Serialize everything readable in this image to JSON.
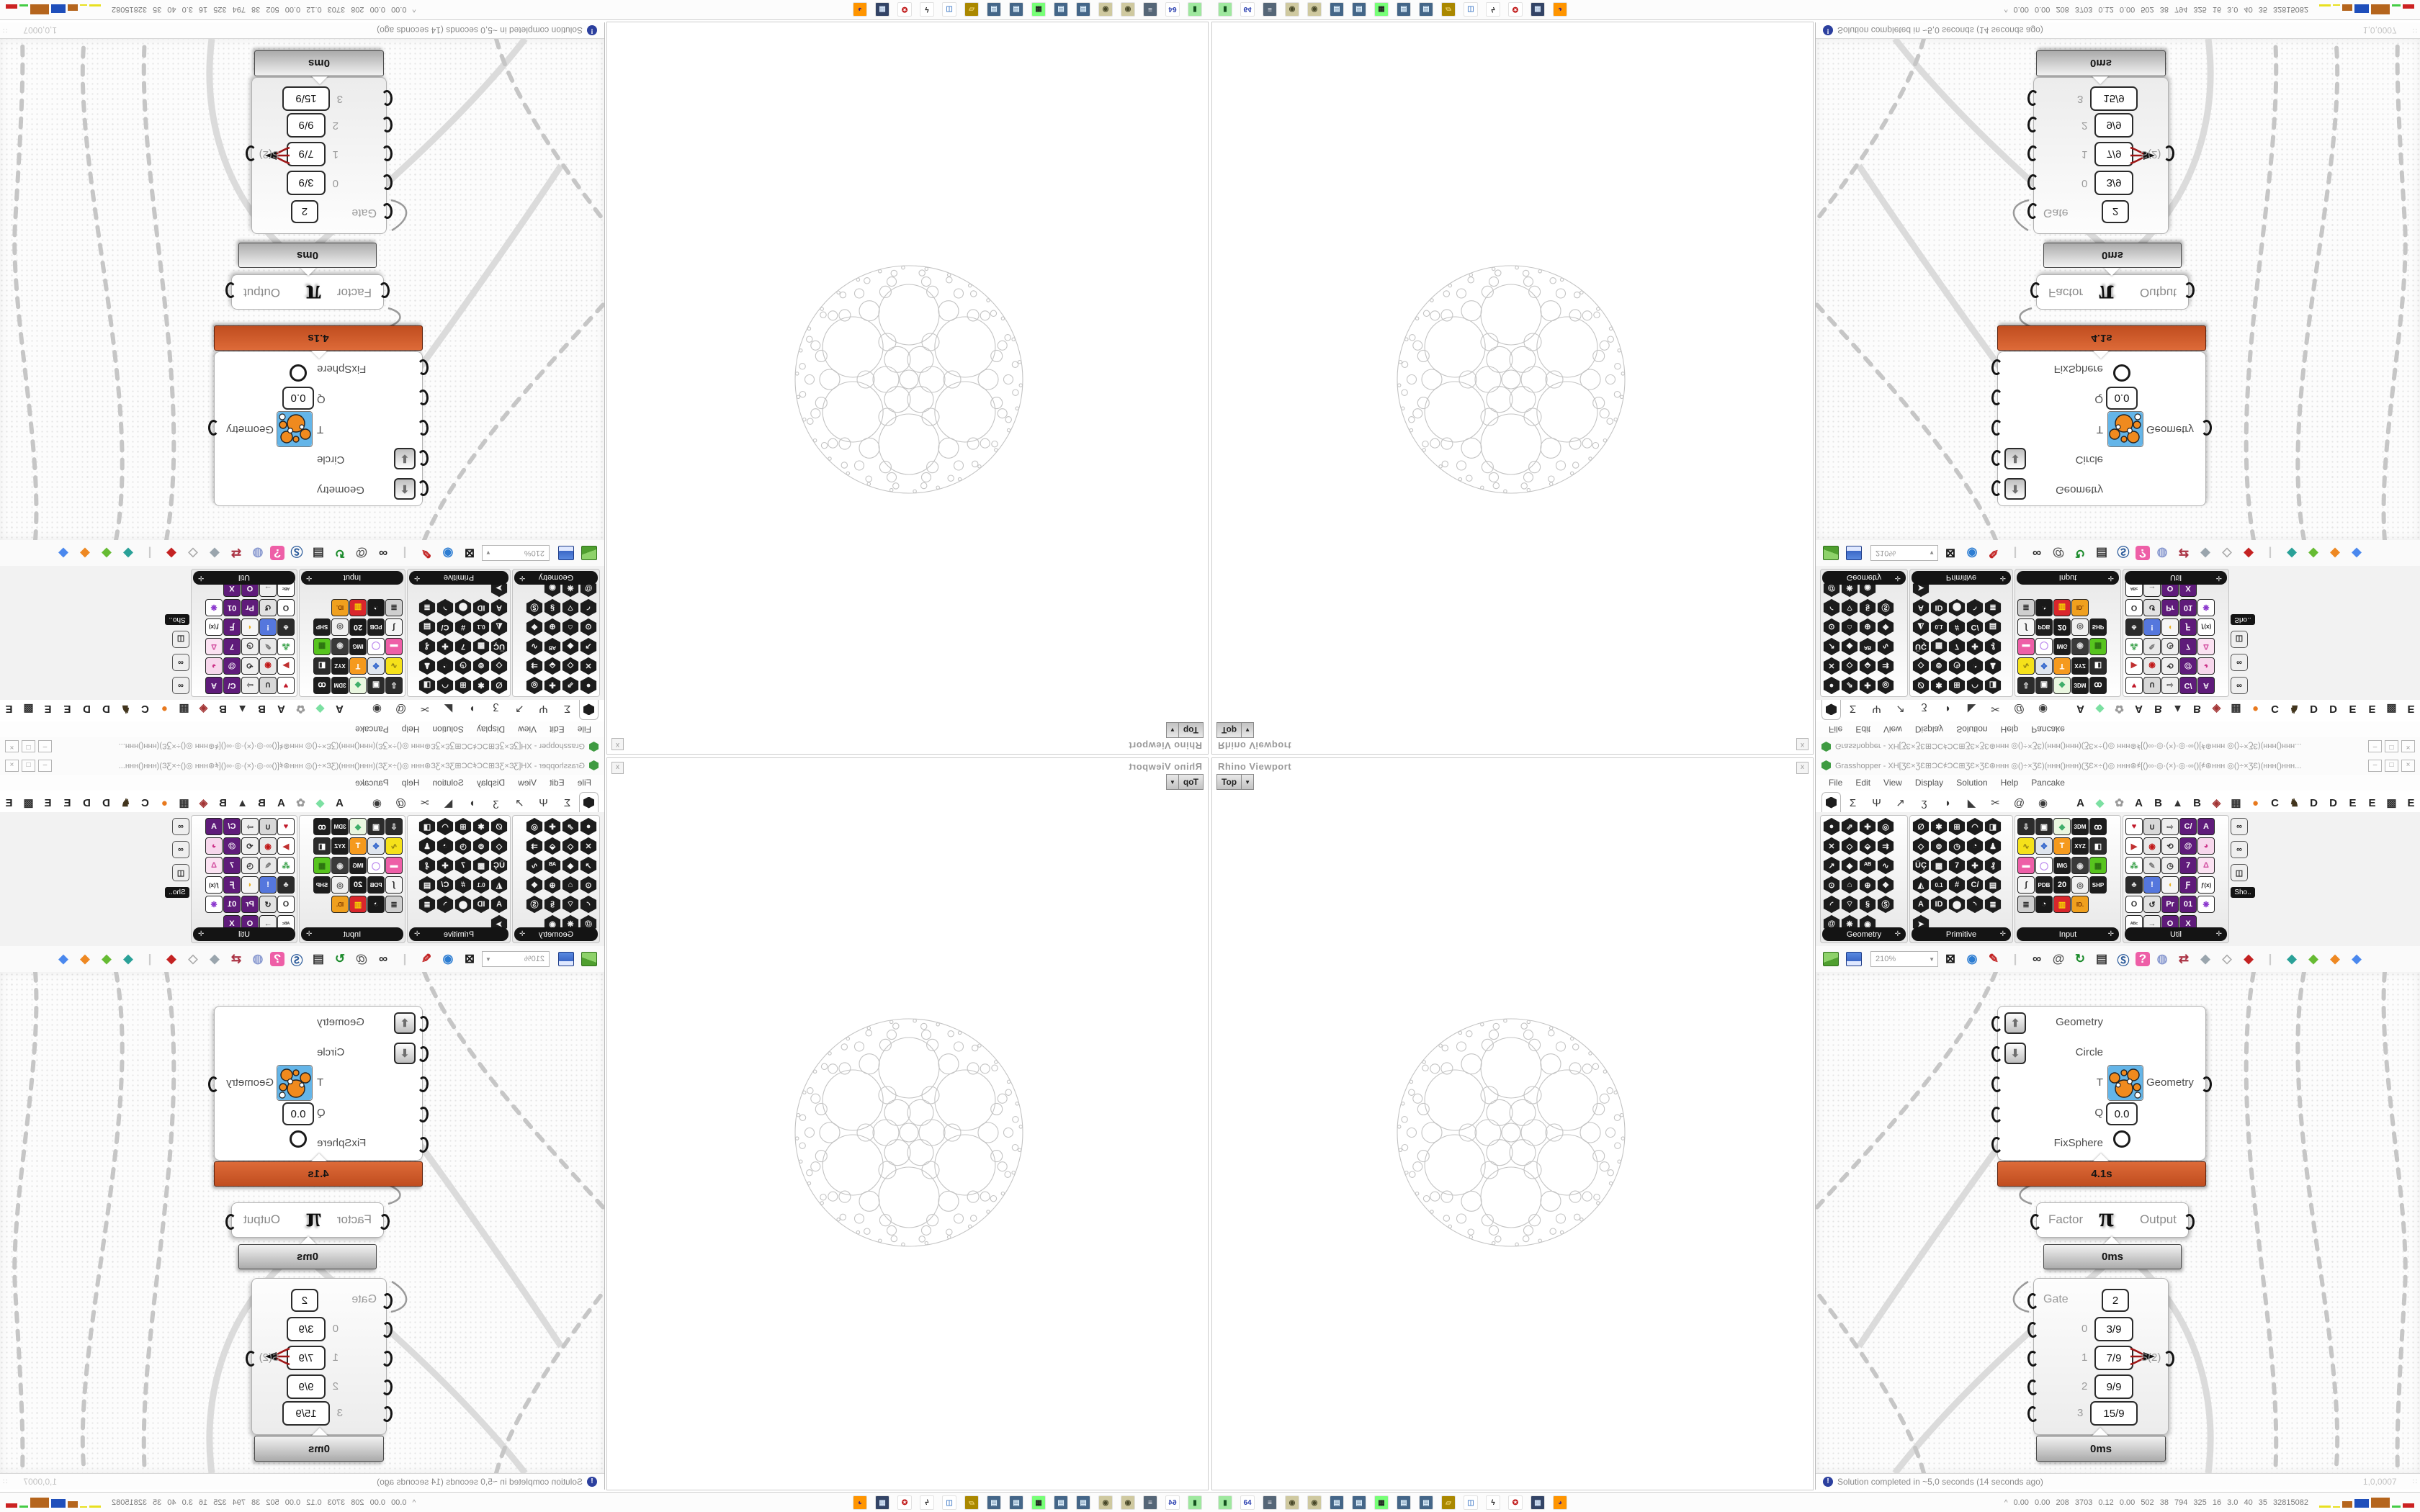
{
  "rhino_viewport": {
    "title": "Rhino Viewport",
    "close_label": "x",
    "viewport_tab": "Top",
    "drop_glyph": "▼"
  },
  "grasshopper": {
    "title": "Grasshopper - XH[ƷƐ×ƷƐ⊞ƆC҂ƆC⊞ƷƐ×ƷƐ⊛ʜʜʜ ◎()÷×ƷƐ)(ʜʜʜ()ʜʜʜ)(ƷƐ×÷()◎ ʜʜʜ⊛҂[()∞·◎·(×)·◎·∞()[҂⊛ʜʜʜ ◎()÷×ƷƐ)(ʜʜʜ()ʜʜʜ...",
    "window_buttons": [
      "–",
      "□",
      "×"
    ],
    "menu": [
      "File",
      "Edit",
      "View",
      "Display",
      "Solution",
      "Help",
      "Pancake"
    ],
    "tab_glyphs": [
      "Σ",
      "Ψ",
      "↗",
      "ʒ",
      "◗",
      "◣",
      "✂",
      "@",
      "◉"
    ],
    "plugin_tabs": [
      [
        "A",
        "#222"
      ],
      [
        "◆",
        "#7ce0a2"
      ],
      [
        "✿",
        "#999"
      ],
      [
        "A",
        "#222"
      ],
      [
        "B",
        "#222"
      ],
      [
        "▲",
        "#333"
      ],
      [
        "B",
        "#222"
      ],
      [
        "◈",
        "#a23333"
      ],
      [
        "▦",
        "#333"
      ],
      [
        "●",
        "#e8791e"
      ],
      [
        "C",
        "#222"
      ],
      [
        "♞",
        "#42351d"
      ],
      [
        "D",
        "#222"
      ],
      [
        "D",
        "#222"
      ],
      [
        "E",
        "#222"
      ],
      [
        "E",
        "#222"
      ],
      [
        "▩",
        "#333"
      ],
      [
        "E",
        "#222"
      ]
    ],
    "palette": {
      "groups": [
        {
          "name": "Geometry",
          "cols": 4,
          "style": "dark",
          "glyphs": [
            "●",
            "⇗",
            "✚",
            "◎",
            "✕",
            "◇",
            "⬙",
            "⇉",
            "↗",
            "◆",
            "ᴬᴮ",
            "∿",
            "⊙",
            "⌂",
            "⊕",
            "❖",
            "◜",
            "⌔",
            "§",
            "Ⓢ",
            "@",
            "❋",
            "◉"
          ]
        },
        {
          "name": "Primitive",
          "cols": 5,
          "style": "dark",
          "glyphs": [
            "∅",
            "✱",
            "⊞",
            "◠",
            "◨",
            "◇",
            "⊚",
            "◷",
            "◔",
            "♟",
            "ÜÇ",
            "▩",
            "7",
            "✚",
            "₰",
            "◭",
            "0.1",
            "#",
            "C/",
            "▤",
            "A",
            "ID",
            "⬤",
            "◝",
            "≣",
            "➤"
          ]
        },
        {
          "name": "Input",
          "cols": 5,
          "style": "color",
          "icons": [
            [
              "⇩",
              "#2b2b2b",
              "#fff"
            ],
            [
              "▣",
              "#2b2b2b",
              "#fff"
            ],
            [
              "◆",
              "#e9f6df",
              "#3fae6a"
            ],
            [
              "3DM",
              "#1d1d1d",
              "#fff"
            ],
            [
              "ꝏ",
              "#1d1d1d",
              "#fff"
            ],
            [
              "∿",
              "#f5e11a",
              "#8a7a10"
            ],
            [
              "✥",
              "#dfe5ee",
              "#3366cc"
            ],
            [
              "T",
              "#f59a1e",
              "#fff"
            ],
            [
              "XYZ",
              "#1d1d1d",
              "#fff"
            ],
            [
              "◧",
              "#2b2b2b",
              "#fff"
            ],
            [
              "▬",
              "#ee5fa7",
              "#fff"
            ],
            [
              "◯",
              "#ffffff",
              "#bb88ee"
            ],
            [
              "IMG",
              "#1d1d1d",
              "#fff"
            ],
            [
              "◉",
              "#3a3a3a",
              "#ddd"
            ],
            [
              "▦",
              "#57c41e",
              "#2a6e10"
            ],
            [
              "∫",
              "#f4f4f4",
              "#222"
            ],
            [
              "PDB",
              "#1d1d1d",
              "#fff"
            ],
            [
              "20",
              "#191919",
              "#fff"
            ],
            [
              "◎",
              "#efefef",
              "#555"
            ],
            [
              "SHP",
              "#1d1d1d",
              "#fff"
            ],
            [
              "≣",
              "#cfcfcf",
              "#333"
            ],
            [
              "◔",
              "#191919",
              "#fff"
            ],
            [
              "▥",
              "#d9262c",
              "#f5d800"
            ],
            [
              "ID.",
              "#f0a01e",
              "#7a3500"
            ]
          ]
        },
        {
          "name": "Util",
          "cols": 5,
          "style": "color",
          "icons": [
            [
              "♥",
              "#ffffff",
              "#c01828"
            ],
            [
              "∪",
              "#d8d8d8",
              "#222"
            ],
            [
              "⇨",
              "#eeeeee",
              "#666"
            ],
            [
              "C/",
              "#5f1b7a",
              "#fff"
            ],
            [
              "A",
              "#5f1b7a",
              "#fff"
            ],
            [
              "▶",
              "#ffffff",
              "#c03030"
            ],
            [
              "◉",
              "#e8e8e8",
              "#c01818"
            ],
            [
              "⟲",
              "#efefef",
              "#333"
            ],
            [
              "@",
              "#5f1b7a",
              "#fff"
            ],
            [
              "◕",
              "#f7d7ec",
              "#cc3388"
            ],
            [
              "⁂",
              "#ffffff",
              "#38a048"
            ],
            [
              "✎",
              "#e8e8e8",
              "#777"
            ],
            [
              "◷",
              "#efefef",
              "#333"
            ],
            [
              "7",
              "#5f1b7a",
              "#fff"
            ],
            [
              "Δ",
              "#fbe2f2",
              "#d24fa0"
            ],
            [
              "♣",
              "#2b2b2b",
              "#ddd"
            ],
            [
              "!",
              "#5577dd",
              "#fff"
            ],
            [
              "◖",
              "#f5f5f5",
              "#e8b020"
            ],
            [
              "Ƒ",
              "#5f1b7a",
              "#fff"
            ],
            [
              "ƒ(x)",
              "#ffffff",
              "#222"
            ],
            [
              "O",
              "#ffffff",
              "#333"
            ],
            [
              "↺",
              "#e2e2e2",
              "#222"
            ],
            [
              "Pr",
              "#5f1b7a",
              "#fff"
            ],
            [
              "01",
              "#5f1b7a",
              "#fff"
            ],
            [
              "❋",
              "#ffffff",
              "#8833cc"
            ],
            [
              "ᴬᴮᶜ",
              "#ffffff",
              "#333"
            ],
            [
              "→",
              "#eeeeee",
              "#666"
            ],
            [
              "O",
              "#5f1b7a",
              "#fff"
            ],
            [
              "X",
              "#5f1b7a",
              "#fff"
            ]
          ]
        }
      ],
      "mini_group": {
        "label": "Sho..",
        "glyphs": [
          "∞",
          "∞",
          "◫"
        ]
      }
    },
    "toolbar": {
      "zoom": "210%",
      "icons": [
        [
          "⊠",
          "#181818"
        ],
        [
          "◉",
          "#2d7dd2"
        ],
        [
          "✎",
          "#c22222"
        ],
        [
          "|",
          "#cccccc"
        ],
        [
          "∞",
          "#222222"
        ],
        [
          "@",
          "#555555"
        ],
        [
          "↻",
          "#1a8a2a"
        ],
        [
          "▤",
          "#333333"
        ],
        [
          "Ⓢ",
          "#2a5a9a"
        ],
        [
          "?",
          "#ffffff",
          "#ee5fa7"
        ],
        [
          "◍",
          "#8a9ad0"
        ],
        [
          "⇄",
          "#aa3344"
        ],
        [
          "◆",
          "#9aa5ad"
        ],
        [
          "◇",
          "#aaaaaa"
        ],
        [
          "◆",
          "#c42222"
        ],
        [
          "|",
          "#cccccc"
        ],
        [
          "◆",
          "#2aa198"
        ],
        [
          "◆",
          "#66bb33"
        ],
        [
          "◆",
          "#ee8822"
        ],
        [
          "◆",
          "#4a88ee"
        ]
      ]
    },
    "status": {
      "message": "Solution completed in ~5,0 seconds (14 seconds ago)",
      "icon_glyph": "!",
      "version": "1,0,0007"
    }
  },
  "components": {
    "fixsphere": {
      "inputs": [
        "Geometry",
        "Circle",
        "T",
        "Q",
        "FixSphere"
      ],
      "q_value": "0.0",
      "up_glyph": "⬆",
      "down_glyph": "⬇",
      "output": "Geometry",
      "runtime": "4.1s"
    },
    "pi": {
      "left": "Factor",
      "glyph": "π",
      "right": "Output",
      "runtime": "0ms"
    },
    "gate": {
      "label": "Gate",
      "gate_value": "2",
      "rows": [
        {
          "index": "0",
          "value": "3/9"
        },
        {
          "index": "1",
          "value": "7/9"
        },
        {
          "index": "2",
          "value": "9/9"
        },
        {
          "index": "3",
          "value": "15/9"
        }
      ],
      "output": "S(2)",
      "runtime": "0ms"
    }
  },
  "taskbar": {
    "icons": [
      [
        "▮",
        "#9fe89f",
        "#14521f"
      ],
      [
        "64",
        "#ffffff",
        "#2a3fb0"
      ],
      [
        "≡",
        "#556677",
        "#e8e8ee"
      ],
      [
        "◉",
        "#cfc9a0",
        "#4a4a2a"
      ],
      [
        "◉",
        "#cfc9a0",
        "#4a4a2a"
      ],
      [
        "▤",
        "#446688",
        "#dceefc"
      ],
      [
        "▤",
        "#446688",
        "#dceefc"
      ],
      [
        "▦",
        "#77ff77",
        "#222222"
      ],
      [
        "▤",
        "#446688",
        "#dceefc"
      ],
      [
        "▤",
        "#446688",
        "#dceefc"
      ],
      [
        "▱",
        "#aa8800",
        "#f5d878"
      ],
      [
        "◫",
        "#ffffff",
        "#5588cc"
      ],
      [
        "ϟ",
        "#ffffff",
        "#111111"
      ],
      [
        "✪",
        "#ffffff",
        "#c01818"
      ],
      [
        "▦",
        "#334466",
        "#cfe0f5"
      ],
      [
        "◕",
        "#ff9500",
        "#4a2a7a"
      ]
    ],
    "expand_glyph": "^",
    "stats": "0.00 0.00 208 3703 0.12 0.00 502 38 794 325 16 3.0 40 35 32815082",
    "meter_bars": [
      [
        "#e8e020",
        16,
        3
      ],
      [
        "#e8e020",
        10,
        2
      ],
      [
        "#b5651d",
        14,
        9
      ],
      [
        "#1f4fbb",
        20,
        12
      ],
      [
        "#b5651d",
        26,
        14
      ],
      [
        "#44cc44",
        12,
        3
      ],
      [
        "#cc2222",
        16,
        6
      ]
    ]
  }
}
